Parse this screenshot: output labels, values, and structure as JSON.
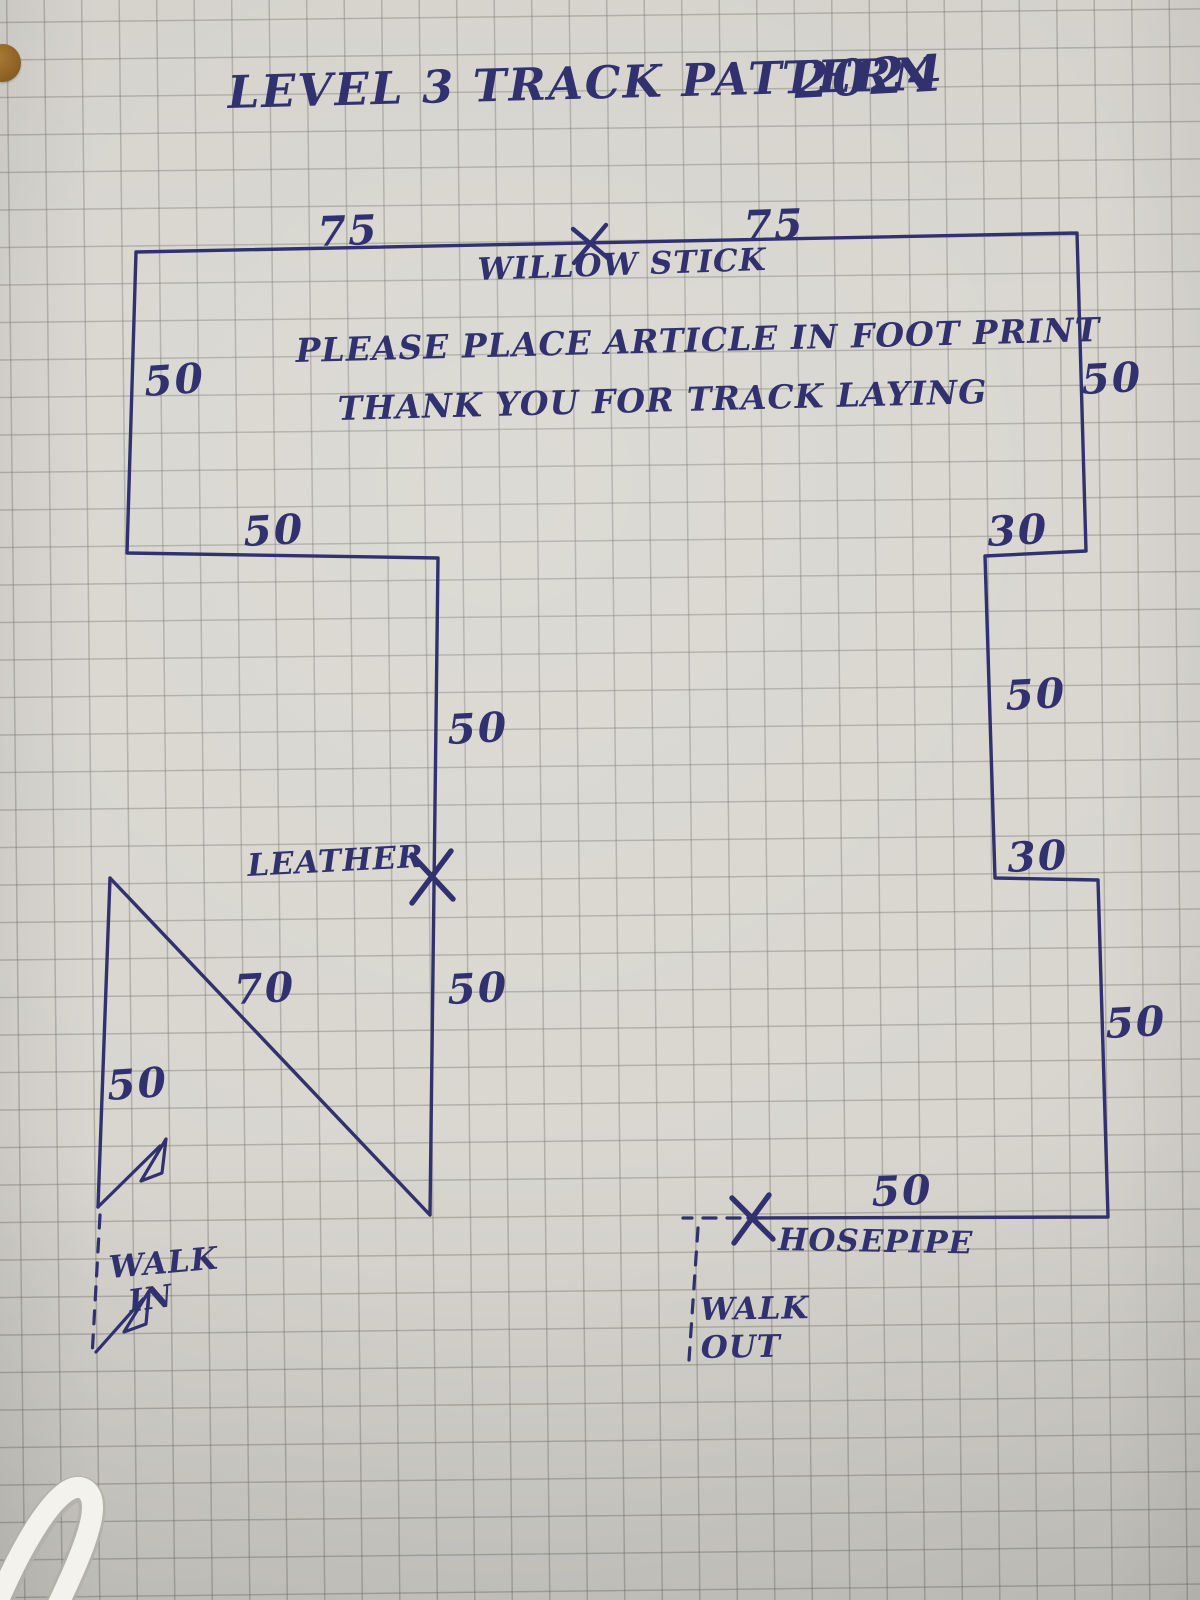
{
  "title": {
    "main": "LEVEL 3 TRACK PATTERN",
    "year": "2024"
  },
  "instructions": {
    "line1": "PLEASE PLACE ARTICLE IN FOOT PRINT",
    "line2": "THANK YOU FOR TRACK LAYING"
  },
  "markers": {
    "willow_stick": "WILLOW STICK",
    "leather": "LEATHER",
    "hosepipe": "HOSEPIPE"
  },
  "walk_in": {
    "line1": "WALK",
    "line2": "IN"
  },
  "walk_out": {
    "line1": "WALK",
    "line2": "OUT"
  },
  "measurements": {
    "top_left": "75",
    "top_right": "75",
    "left_upper": "50",
    "shelf": "50",
    "mid_upper": "50",
    "mid_lower": "50",
    "diagonal": "70",
    "left_lower": "50",
    "right_upper": "50",
    "jog_top": "30",
    "right_mid": "50",
    "jog_bottom": "30",
    "right_lower": "50",
    "bottom": "50"
  },
  "colors": {
    "ink": "#31316f",
    "paper": "#d8d6cf",
    "grid": "#7a7870",
    "sticker_dot": "#8a5e22",
    "cable": "#f3f2ec"
  }
}
